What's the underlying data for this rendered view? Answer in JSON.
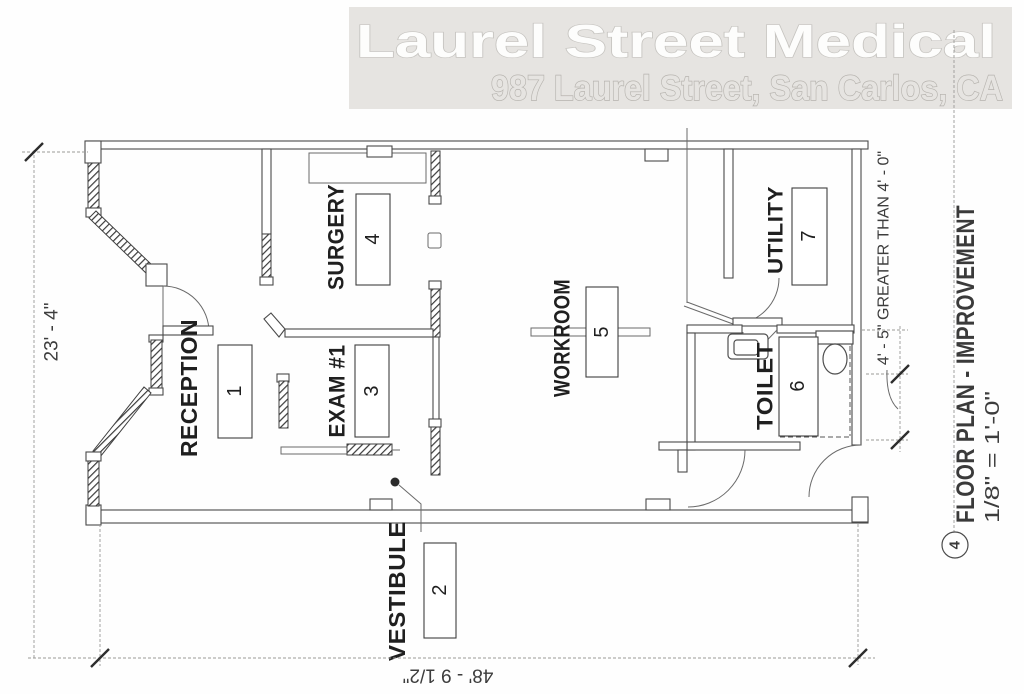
{
  "header": {
    "title": "Laurel Street Medical",
    "subtitle": "987 Laurel Street, San Carlos, CA",
    "bg_color": "#e6e4e1"
  },
  "rooms": {
    "reception": {
      "label": "RECEPTION",
      "number": "1"
    },
    "vestibule": {
      "label": "VESTIBULE",
      "number": "2"
    },
    "exam1": {
      "label": "EXAM #1",
      "number": "3"
    },
    "surgery": {
      "label": "SURGERY",
      "number": "4"
    },
    "workroom": {
      "label": "WORKROOM",
      "number": "5"
    },
    "toilet": {
      "label": "TOILET",
      "number": "6"
    },
    "utility": {
      "label": "UTILITY",
      "number": "7"
    }
  },
  "dimensions": {
    "left": "23' - 4\"",
    "bottom": "48' - 9 1/2\"",
    "right": "4' - 5\" GREATER THAN 4' - 0\""
  },
  "title_block": {
    "drawing_title": "FLOOR PLAN - IMPROVEMENT",
    "scale": "1/8\" = 1'-0\"",
    "detail_number": "4"
  }
}
